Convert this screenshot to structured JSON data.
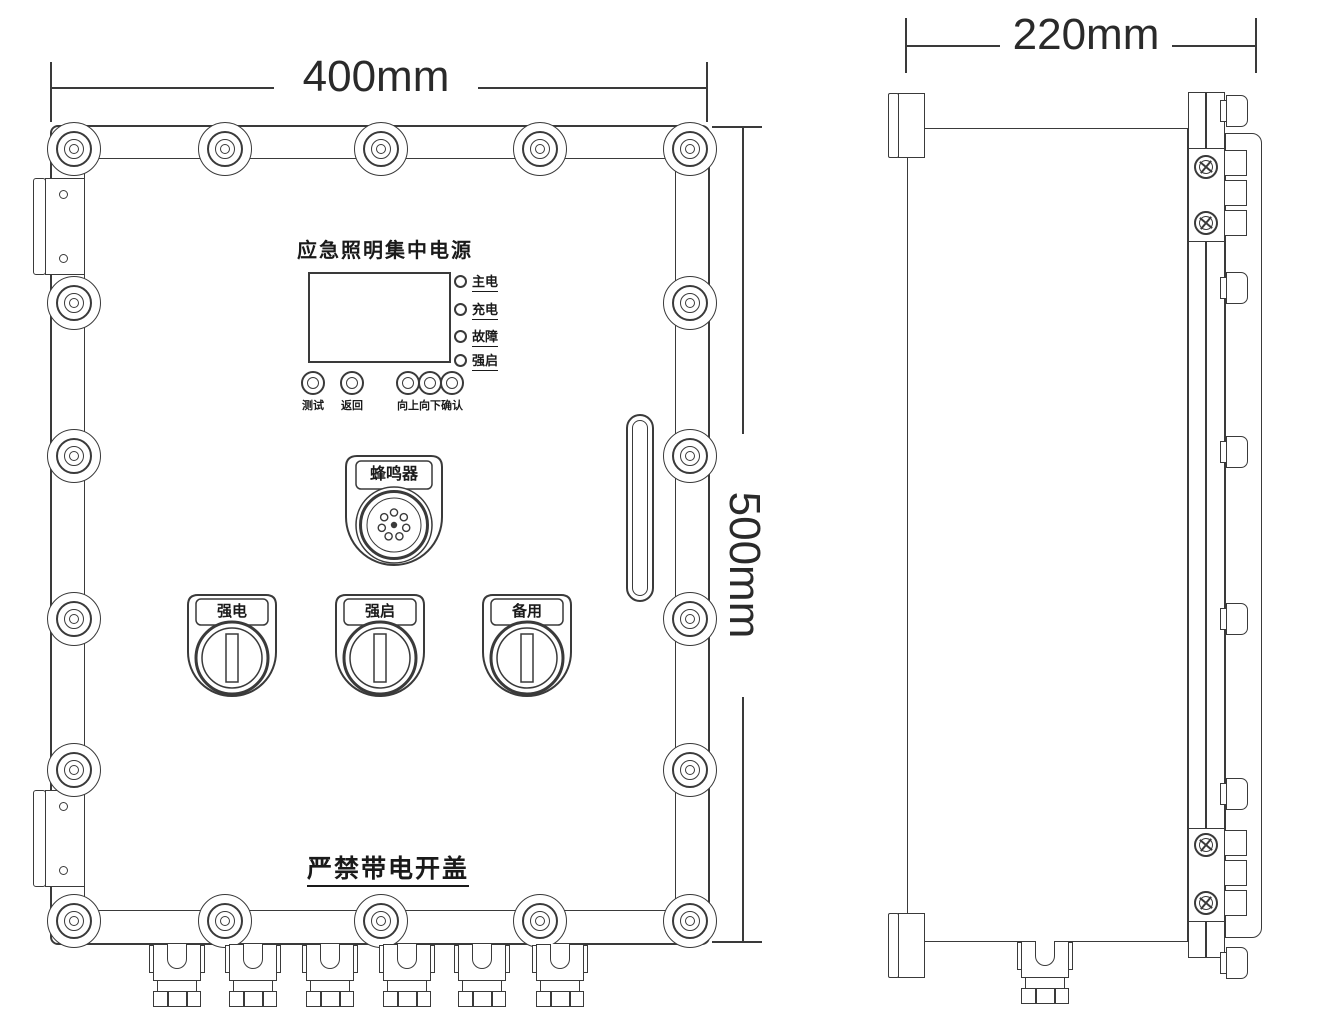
{
  "front_view": {
    "title": "应急照明集中电源",
    "width_dimension": "400mm",
    "height_dimension": "500mm",
    "indicators": [
      {
        "label": "主电"
      },
      {
        "label": "充电"
      },
      {
        "label": "故障"
      },
      {
        "label": "强启"
      }
    ],
    "buttons": [
      {
        "label": "测试"
      },
      {
        "label": "返回"
      },
      {
        "label": "向上"
      },
      {
        "label": "向下"
      },
      {
        "label": "确认"
      }
    ],
    "buzzer_label": "蜂鸣器",
    "switches": [
      {
        "label": "强电"
      },
      {
        "label": "强启"
      },
      {
        "label": "备用"
      }
    ],
    "warning": "严禁带电开盖"
  },
  "side_view": {
    "depth_dimension": "220mm"
  },
  "icons": {
    "bolt": "bolt-icon",
    "crosshead_screw": "crosshead-screw-icon",
    "speaker": "buzzer-speaker-icon",
    "key_slot": "key-slot-icon",
    "handle": "door-handle"
  },
  "colors": {
    "line": "#3a3a3a",
    "text": "#1a1a1a",
    "background": "#ffffff"
  }
}
